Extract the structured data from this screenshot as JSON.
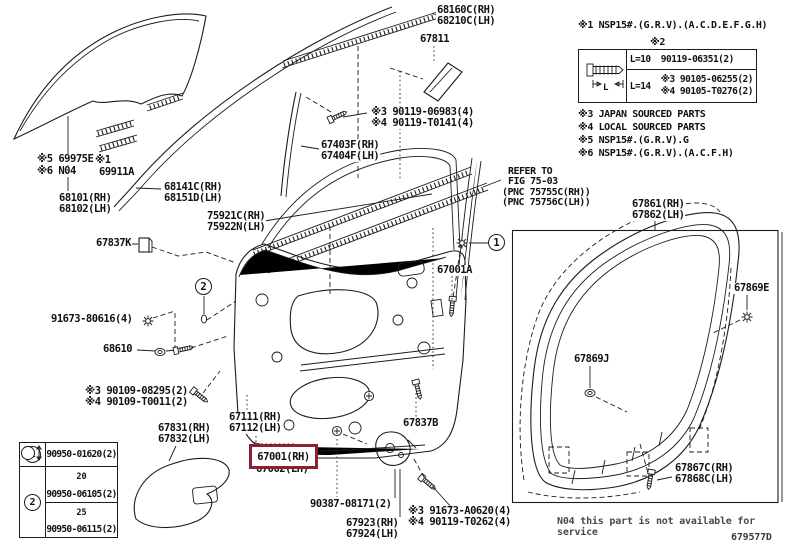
{
  "figure": {
    "code": "679577D",
    "service_note": "N04 this part is not available for service"
  },
  "side_notes": {
    "note1": "※1 NSP15#.(G.R.V).(A.C.D.E.F.G.H)",
    "note2": "※2",
    "note3": "※3 JAPAN SOURCED PARTS",
    "note4": "※4 LOCAL SOURCED PARTS",
    "note5": "※5 NSP15#.(G.R.V).G",
    "note6": "※6 NSP15#.(G.R.V).(A.C.F.H)"
  },
  "bolt_table": {
    "dim_label": "L",
    "rows": [
      {
        "length": "L=10",
        "parts": [
          "90119-06351(2)"
        ]
      },
      {
        "length": "L=14",
        "parts": [
          "※3 90105-06255(2)",
          "※4 90105-T0276(2)"
        ]
      }
    ]
  },
  "legend_table": {
    "row1": {
      "index": "1",
      "part": "90950-01620(2)"
    },
    "row2": {
      "index": "2",
      "items": [
        {
          "dim": "20",
          "part": "90950-06105(2)"
        },
        {
          "dim": "25",
          "part": "90950-06115(2)"
        }
      ]
    }
  },
  "refer_note": {
    "lines": [
      "REFER TO",
      "FIG 75-03",
      "(PNC 75755C(RH))",
      "(PNC 75756C(LH))"
    ]
  },
  "callouts": {
    "c1": "1",
    "c2": "2"
  },
  "highlight": {
    "part": "67001(RH)",
    "color": "#8e1f33"
  },
  "labels": [
    {
      "id": "69975e",
      "x": 36,
      "y": 154,
      "lines": [
        "※5 69975E"
      ]
    },
    {
      "id": "mark1",
      "x": 94,
      "y": 155,
      "lines": [
        "※1"
      ]
    },
    {
      "id": "n04",
      "x": 36,
      "y": 166,
      "lines": [
        "※6 N04"
      ]
    },
    {
      "id": "69911a",
      "x": 98,
      "y": 167,
      "lines": [
        "69911A"
      ]
    },
    {
      "id": "68101",
      "x": 58,
      "y": 193,
      "lines": [
        "68101(RH)",
        "68102(LH)"
      ]
    },
    {
      "id": "68141c",
      "x": 163,
      "y": 182,
      "lines": [
        "68141C(RH)",
        "68151D(LH)"
      ]
    },
    {
      "id": "68160c",
      "x": 436,
      "y": 5,
      "lines": [
        "68160C(RH)",
        "68210C(LH)"
      ]
    },
    {
      "id": "67811",
      "x": 419,
      "y": 34,
      "lines": [
        "67811"
      ]
    },
    {
      "id": "90119-06983",
      "x": 370,
      "y": 107,
      "lines": [
        "※3 90119-06983(4)",
        "※4 90119-T0141(4)"
      ]
    },
    {
      "id": "67403f",
      "x": 320,
      "y": 140,
      "lines": [
        "67403F(RH)",
        "67404F(LH)"
      ]
    },
    {
      "id": "75921c",
      "x": 206,
      "y": 211,
      "lines": [
        "75921C(RH)",
        "75922N(LH)"
      ]
    },
    {
      "id": "67837k",
      "x": 95,
      "y": 238,
      "lines": [
        "67837K"
      ]
    },
    {
      "id": "91673-80616",
      "x": 50,
      "y": 314,
      "lines": [
        "91673-80616(4)"
      ]
    },
    {
      "id": "68610",
      "x": 102,
      "y": 344,
      "lines": [
        "68610"
      ]
    },
    {
      "id": "90109-08295",
      "x": 84,
      "y": 386,
      "lines": [
        "※3 90109-08295(2)",
        "※4 90109-T0011(2)"
      ]
    },
    {
      "id": "67831",
      "x": 157,
      "y": 423,
      "lines": [
        "67831(RH)",
        "67832(LH)"
      ]
    },
    {
      "id": "67111",
      "x": 228,
      "y": 412,
      "lines": [
        "67111(RH)",
        "67112(LH)"
      ]
    },
    {
      "id": "67002",
      "x": 255,
      "y": 464,
      "lines": [
        "67002(LH)"
      ]
    },
    {
      "id": "67837b",
      "x": 402,
      "y": 418,
      "lines": [
        "67837B"
      ]
    },
    {
      "id": "90387-08171",
      "x": 309,
      "y": 499,
      "lines": [
        "90387-08171(2)"
      ]
    },
    {
      "id": "67923",
      "x": 345,
      "y": 518,
      "lines": [
        "67923(RH)",
        "67924(LH)"
      ]
    },
    {
      "id": "91673-a0620",
      "x": 407,
      "y": 506,
      "lines": [
        "※3 91673-A0620(4)",
        "※4 90119-T0262(4)"
      ]
    },
    {
      "id": "67001a",
      "x": 436,
      "y": 265,
      "lines": [
        "67001A"
      ]
    },
    {
      "id": "67861",
      "x": 631,
      "y": 199,
      "lines": [
        "67861(RH)",
        "67862(LH)"
      ]
    },
    {
      "id": "67869e",
      "x": 733,
      "y": 283,
      "lines": [
        "67869E"
      ]
    },
    {
      "id": "67869j",
      "x": 573,
      "y": 354,
      "lines": [
        "67869J"
      ]
    },
    {
      "id": "67867c",
      "x": 674,
      "y": 463,
      "lines": [
        "67867C(RH)",
        "67868C(LH)"
      ]
    }
  ]
}
